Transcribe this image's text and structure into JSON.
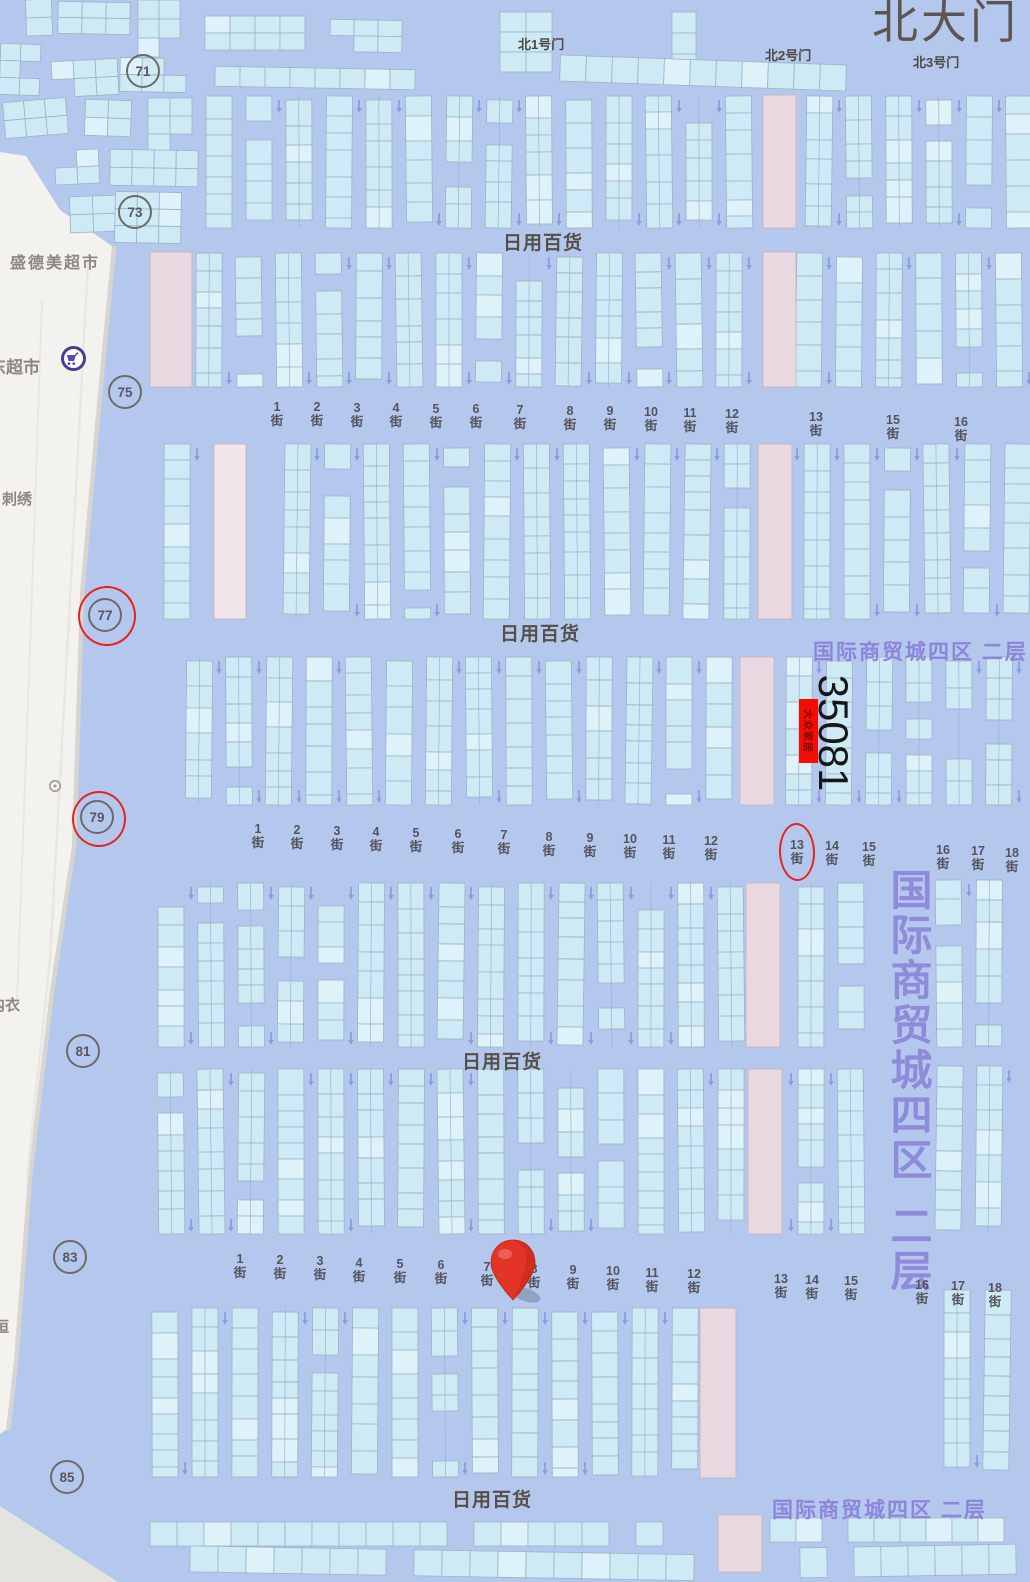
{
  "map": {
    "title_gate": "北大门",
    "gates": [
      "北1号门",
      "北2号门",
      "北3号门"
    ],
    "area_labels": [
      "日用百货",
      "日用百货",
      "日用百货",
      "日用百货"
    ],
    "zone_label_top": "国际商贸城四区  二层",
    "zone_label_bottom": "国际商贸城四区  二层",
    "zone_label_vertical_main": "国际商贸城四区",
    "zone_label_vertical_floor": "二层",
    "road_markers": [
      "71",
      "73",
      "75",
      "77",
      "79",
      "81",
      "83",
      "85"
    ],
    "street_rows": [
      {
        "items": [
          "1街",
          "2街",
          "3街",
          "4街",
          "5街",
          "6街",
          "7街",
          "8街",
          "9街",
          "10街",
          "11街",
          "12街",
          "13街",
          "15街",
          "16街"
        ]
      },
      {
        "items": [
          "1街",
          "2街",
          "3街",
          "4街",
          "5街",
          "6街",
          "7街",
          "8街",
          "9街",
          "10街",
          "11街",
          "12街",
          "13街",
          "14街",
          "15街",
          "16街",
          "17街",
          "18街"
        ]
      },
      {
        "items": [
          "1街",
          "2街",
          "3街",
          "4街",
          "5街",
          "6街",
          "7街",
          "8街",
          "9街",
          "10街",
          "11街",
          "12街",
          "13街",
          "14街",
          "15街",
          "16街",
          "17街",
          "18街"
        ]
      }
    ],
    "booth": {
      "number": "35081",
      "tag": "大众家居"
    },
    "roadside": {
      "store_top": "盛德美超市",
      "supermarket": "东超市",
      "embroidery": "刺绣",
      "clothing": "内衣",
      "partial": "恒"
    },
    "annotations": {
      "ringed_markers": [
        "77",
        "79"
      ],
      "circled_street": "13街",
      "pin_between": "7街 8街"
    },
    "colors": {
      "background": "#b4c8ee",
      "stall": "#cdeaf5",
      "stall_border": "#9db3c7",
      "pink_block": "#e9d8df",
      "road": "#f3f2ee",
      "accent_red": "#e6241b",
      "booth_tag_red": "#f20d05",
      "purple_text": "#8a82d8",
      "pin_red": "#e33527",
      "gray_text": "#564f47"
    }
  }
}
